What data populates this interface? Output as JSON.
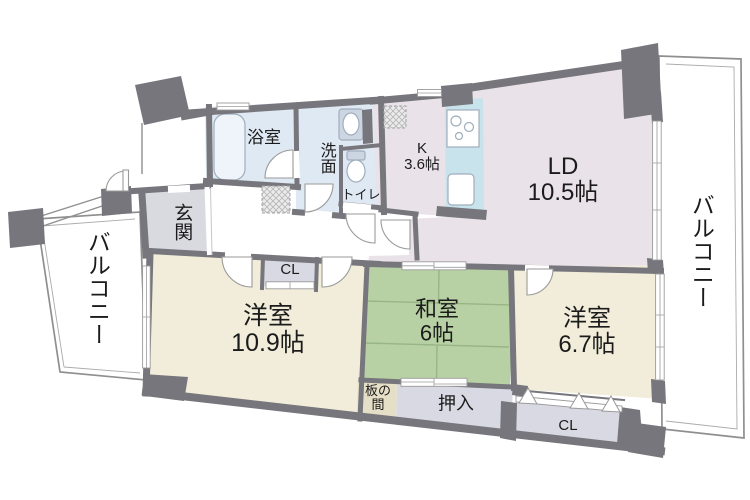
{
  "floorplan": {
    "rooms": {
      "ld": {
        "name": "LD",
        "size": "10.5帖"
      },
      "kitchen": {
        "name": "K",
        "size": "3.6帖"
      },
      "bath": {
        "name": "浴室"
      },
      "washroom": {
        "name": "洗面"
      },
      "toilet": {
        "name": "トイレ"
      },
      "entrance": {
        "name": "玄関"
      },
      "western_a": {
        "name": "洋室",
        "size": "10.9帖"
      },
      "japanese": {
        "name": "和室",
        "size": "6帖"
      },
      "western_b": {
        "name": "洋室",
        "size": "6.7帖"
      },
      "oshiire": {
        "name": "押入"
      },
      "itanoma": {
        "name": "板の間",
        "line1": "板の",
        "line2": "間"
      },
      "closet_hall": {
        "name": "CL"
      },
      "closet_bedroom": {
        "name": "CL"
      },
      "balcony_left": {
        "name": "バルコニー"
      },
      "balcony_right": {
        "name": "バルコニー"
      }
    },
    "colors": {
      "wall": "#76767c",
      "water_rooms": "#dfe9f3",
      "kitchen_counter": "#c9e3ec",
      "living": "#e9e2e8",
      "western_room": "#f1edda",
      "tatami": "#b8d1a4",
      "tatami_line": "#98b585",
      "closet": "#d9d9e3",
      "entrance_floor": "#d9d9e0",
      "itanoma_floor": "#e6dfc7"
    }
  }
}
